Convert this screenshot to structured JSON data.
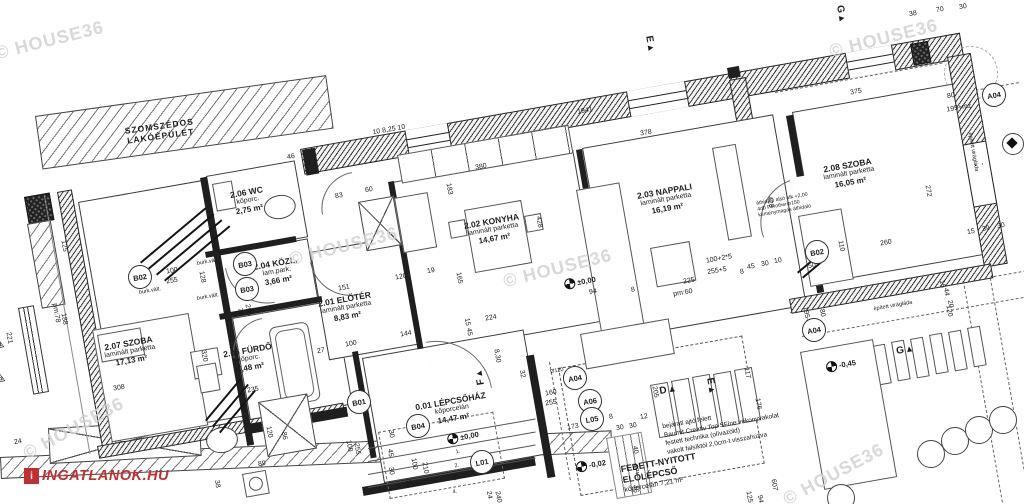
{
  "logo": {
    "text": "INGATLANOK.HU",
    "color": "#c22f2f"
  },
  "watermark": {
    "text": "© HOUSE36",
    "color": "#d2d2d2",
    "positions": [
      [
        -6,
        30,
        -14
      ],
      [
        828,
        28,
        -14
      ],
      [
        288,
        236,
        -14
      ],
      [
        502,
        258,
        -14
      ],
      [
        778,
        464,
        -28
      ],
      [
        18,
        418,
        -28
      ]
    ]
  },
  "neighbor": {
    "line1": "SZOMSZÉDOS",
    "line2": "LAKÓÉPÜLET"
  },
  "rooms": [
    {
      "id": "2.07",
      "name": "SZOBA",
      "floor": "laminált parketta",
      "area": "17,13 m²",
      "rect": [
        78,
        202,
        128,
        238
      ],
      "label": [
        130,
        352
      ]
    },
    {
      "id": "2.06",
      "name": "WC",
      "floor": "kőporc.",
      "area": "2,75 m²",
      "rect": [
        206,
        176,
        88,
        76
      ],
      "label": [
        248,
        201
      ]
    },
    {
      "id": "2.04",
      "name": "KÖZL.",
      "floor": "lam.park.",
      "area": "3,66 m²",
      "rect": [
        219,
        254,
        88,
        60
      ],
      "label": [
        277,
        272
      ]
    },
    {
      "id": "2.05",
      "name": "FÜRDŐ",
      "floor": "kőporc.",
      "area": "7,48 m²",
      "rect": [
        232,
        318,
        102,
        104
      ],
      "label": [
        249,
        359
      ]
    },
    {
      "id": "2.01",
      "name": "ELŐTÉR",
      "floor": "laminált parketta",
      "area": "8,83 m²",
      "rect": [
        310,
        252,
        112,
        108
      ],
      "label": [
        346,
        308
      ]
    },
    {
      "id": "2.02",
      "name": "KONYHA",
      "floor": "laminált parketta",
      "area": "14,67 m²",
      "rect": [
        392,
        182,
        182,
        172
      ],
      "label": [
        493,
        230
      ]
    },
    {
      "id": "2.03",
      "name": "NAPPALI",
      "floor": "laminált parketta",
      "area": "16,19 m²",
      "rect": [
        582,
        148,
        192,
        192
      ],
      "label": [
        666,
        200
      ]
    },
    {
      "id": "2.08",
      "name": "SZOBA",
      "floor": "laminált parketta",
      "area": "16,05 m²",
      "rect": [
        792,
        112,
        162,
        172
      ],
      "label": [
        849,
        174
      ]
    },
    {
      "id": "0.01",
      "name": "LÉPCSŐHÁZ",
      "floor": "kőporcelán",
      "area": "14,47 m²",
      "rect": [
        362,
        358,
        162,
        125
      ],
      "label": [
        452,
        410
      ]
    }
  ],
  "terrace": {
    "rect": [
      558,
      368,
      185,
      128
    ],
    "label": [
      660,
      473
    ],
    "lines": [
      "FEDETT-NYITOTT",
      "ELŐLÉPCSŐ",
      "kőporcelán 7,21 m²"
    ]
  },
  "entry_note": {
    "x": 664,
    "y": 413,
    "lines": [
      "bejárati ajtó felett",
      "Baumit Creativ Top SFine vékonyvakolat",
      "festett technika (olívazöld)",
      "vakolt falsíktól 2,0cm-t visszahúzva"
    ]
  },
  "lintel_note": {
    "x": 757,
    "y": 196,
    "lines": [
      "áthidaló alsó afk +2,00",
      "4db Porotherm150",
      "kéménymagas áthidaló"
    ]
  },
  "levels": [
    {
      "t": "±0,00",
      "x": 580,
      "y": 282
    },
    {
      "t": "±0,00",
      "x": 463,
      "y": 437
    },
    {
      "t": "-0,02",
      "x": 591,
      "y": 465
    },
    {
      "t": "-0,45",
      "x": 841,
      "y": 365
    }
  ],
  "bubbles": [
    [
      "B02",
      140,
      277
    ],
    [
      "B03",
      245,
      264
    ],
    [
      "B03",
      247,
      289
    ],
    [
      "B01",
      359,
      402
    ],
    [
      "B04",
      418,
      426
    ],
    [
      "L01",
      482,
      462
    ],
    [
      "A04",
      575,
      378
    ],
    [
      "A06",
      590,
      401
    ],
    [
      "L05",
      592,
      419
    ],
    [
      "A04",
      814,
      330
    ],
    [
      "B02",
      817,
      252
    ],
    [
      "A04",
      994,
      95
    ]
  ],
  "markers": [
    [
      "F",
      480,
      377,
      -100
    ],
    [
      "D",
      668,
      390,
      -10
    ],
    [
      "E",
      711,
      386,
      80
    ],
    [
      "E",
      650,
      44,
      80
    ],
    [
      "G",
      841,
      14,
      80
    ],
    [
      "G",
      905,
      350,
      -10
    ]
  ],
  "step_numbers": [
    [
      "1.",
      458,
      452
    ],
    [
      "2.",
      457,
      466
    ],
    [
      "3.",
      456,
      479
    ],
    [
      "4.",
      455,
      492
    ]
  ],
  "tri_markers": [
    [
      "1",
      344,
      428
    ],
    [
      "2",
      366,
      420
    ]
  ],
  "small_labels": [
    [
      "burk.vált.",
      150,
      291,
      -10
    ],
    [
      "burk.vált.",
      208,
      262,
      -10
    ],
    [
      "burk.vált.",
      208,
      297,
      -10
    ],
    [
      "épített virágláda",
      893,
      306,
      -10
    ],
    [
      "épített virágláda",
      973,
      152,
      80
    ],
    [
      "Ø120",
      557,
      371,
      -10
    ]
  ],
  "dims": [
    [
      "1941",
      585,
      111,
      -10
    ],
    [
      "10  8,25  10",
      389,
      130,
      -10
    ],
    [
      "46",
      291,
      157,
      -10
    ],
    [
      "380",
      481,
      167,
      -10
    ],
    [
      "378",
      646,
      133,
      -10
    ],
    [
      "375",
      856,
      92,
      -10
    ],
    [
      "38",
      913,
      14,
      -10
    ],
    [
      "70",
      940,
      10,
      -10
    ],
    [
      "30",
      963,
      7,
      -10
    ],
    [
      "83",
      339,
      196,
      -10
    ],
    [
      "60",
      369,
      190,
      -10
    ],
    [
      "183",
      449,
      189,
      80
    ],
    [
      "428",
      539,
      222,
      80
    ],
    [
      "428",
      770,
      202,
      80
    ],
    [
      "151",
      344,
      288,
      -10
    ],
    [
      "120",
      401,
      277,
      -10
    ],
    [
      "19",
      431,
      271,
      -10
    ],
    [
      "165",
      459,
      278,
      80
    ],
    [
      "224",
      491,
      318,
      -10
    ],
    [
      "15",
      467,
      322,
      80
    ],
    [
      "45",
      469,
      332,
      80
    ],
    [
      "8,30",
      497,
      356,
      80
    ],
    [
      "32",
      522,
      374,
      80
    ],
    [
      "100+2*5",
      719,
      259,
      -10
    ],
    [
      "255+5",
      717,
      271,
      -10
    ],
    [
      "45",
      751,
      267,
      -10
    ],
    [
      "30",
      765,
      264,
      -10
    ],
    [
      "10",
      778,
      261,
      -10
    ],
    [
      "225",
      689,
      281,
      -10
    ],
    [
      "pm:60",
      683,
      293,
      -10
    ],
    [
      "94",
      593,
      292,
      -10
    ],
    [
      "8",
      633,
      290,
      -10
    ],
    [
      "8",
      742,
      272,
      -10
    ],
    [
      "100",
      172,
      271,
      -10
    ],
    [
      "255",
      172,
      281,
      -10
    ],
    [
      "128",
      202,
      277,
      80
    ],
    [
      "75",
      240,
      312,
      80
    ],
    [
      "255",
      248,
      310,
      80
    ],
    [
      "308",
      119,
      388,
      -10
    ],
    [
      "235",
      253,
      390,
      -10
    ],
    [
      "320",
      204,
      356,
      80
    ],
    [
      "27",
      321,
      351,
      -10
    ],
    [
      "120",
      269,
      432,
      80
    ],
    [
      "86",
      284,
      436,
      80
    ],
    [
      "89",
      262,
      464,
      -10
    ],
    [
      "38",
      217,
      484,
      80
    ],
    [
      "24",
      18,
      442,
      -10
    ],
    [
      "125",
      64,
      246,
      80
    ],
    [
      "pm:78",
      56,
      313,
      80
    ],
    [
      "188",
      64,
      319,
      80
    ],
    [
      "221",
      9,
      338,
      80
    ],
    [
      "144",
      406,
      334,
      -10
    ],
    [
      "100",
      351,
      344,
      -10
    ],
    [
      "100",
      349,
      446,
      80
    ],
    [
      "255",
      357,
      449,
      80
    ],
    [
      "30",
      391,
      434,
      80
    ],
    [
      "45",
      390,
      453,
      80
    ],
    [
      "30",
      391,
      471,
      80
    ],
    [
      "100",
      414,
      464,
      80
    ],
    [
      "210",
      425,
      468,
      80
    ],
    [
      "10",
      408,
      483,
      80
    ],
    [
      "160",
      551,
      393,
      -10
    ],
    [
      "255",
      551,
      403,
      -10
    ],
    [
      "24",
      489,
      495,
      80
    ],
    [
      "240",
      498,
      497,
      80
    ],
    [
      "173",
      573,
      427,
      -10
    ],
    [
      "8",
      611,
      417,
      -10
    ],
    [
      "12",
      644,
      417,
      -10
    ],
    [
      "30",
      620,
      428,
      -10
    ],
    [
      "30",
      633,
      426,
      -10
    ],
    [
      "205",
      655,
      392,
      80
    ],
    [
      "117",
      747,
      373,
      80
    ],
    [
      "176",
      758,
      404,
      80
    ],
    [
      "40",
      635,
      450,
      80
    ],
    [
      "47",
      635,
      468,
      80
    ],
    [
      "46",
      635,
      489,
      80
    ],
    [
      "607",
      774,
      485,
      80
    ],
    [
      "125",
      749,
      497,
      80
    ],
    [
      "94",
      760,
      499,
      80
    ],
    [
      "110",
      841,
      246,
      80
    ],
    [
      "260",
      886,
      243,
      -10
    ],
    [
      "272",
      928,
      191,
      80
    ],
    [
      "15",
      971,
      232,
      -10
    ],
    [
      "39",
      986,
      229,
      -10
    ],
    [
      "30",
      1001,
      226,
      -10
    ],
    [
      "80",
      951,
      96,
      -10
    ],
    [
      "195+mz",
      959,
      108,
      -10
    ],
    [
      "80",
      822,
      313,
      80
    ],
    [
      "195+mz",
      807,
      319,
      80
    ],
    [
      "120",
      949,
      311,
      80
    ],
    [
      "15",
      942,
      284,
      80
    ],
    [
      "44",
      946,
      292,
      80
    ],
    [
      "20",
      950,
      304,
      80
    ],
    [
      "50",
      812,
      266,
      -10
    ]
  ]
}
